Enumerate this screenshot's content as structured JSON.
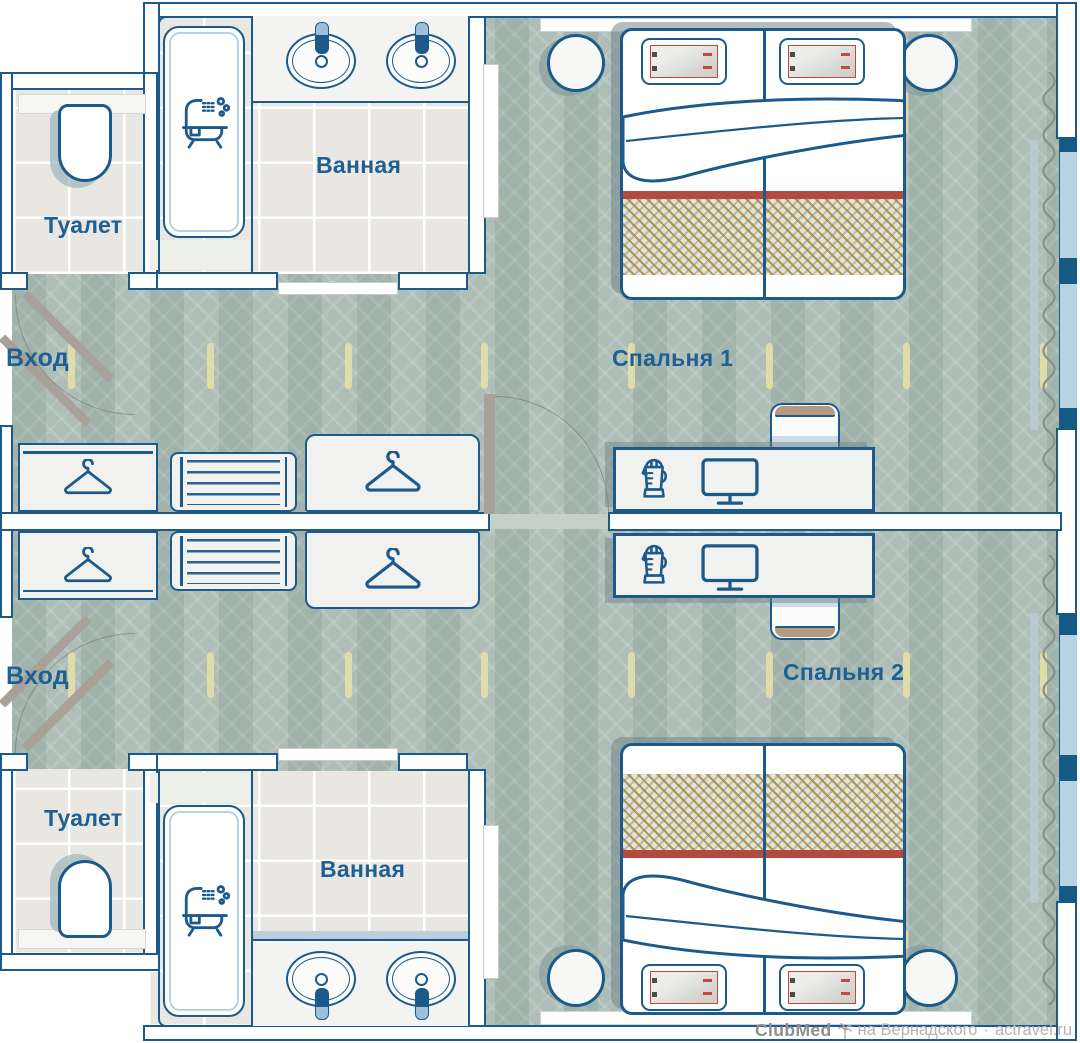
{
  "page": {
    "type": "hotel-room-floor-plan",
    "rooms_shown": 2
  },
  "labels": {
    "entrance": "Вход",
    "toilet": "Туалет",
    "bathroom": "Ванная",
    "bedroom1": "Спальня 1",
    "bedroom2": "Спальня 2"
  },
  "watermark": {
    "brand": "ClubMed",
    "location": "на Вернадского",
    "separator": "·",
    "site": "actravel.ru"
  },
  "icons": {
    "toilet-icon": "toilet top view",
    "bathtub-icon": "bathtub with shower and bubbles",
    "sink-icon": "washbasin with faucet",
    "hanger-icon": "clothes hanger (wardrobe)",
    "shelf-icon": "shelf unit",
    "kettle-icon": "electric kettle",
    "monitor-icon": "tv / monitor on desk",
    "palm-icon": "palm tree (ClubMed logo)",
    "curtain-icon": "window curtain wave"
  },
  "colors": {
    "wall_outline": "#1d5a8c",
    "label_text": "#1e6093",
    "carpet": "#a9bab2",
    "tile_floor": "#e9e7e1",
    "furniture_fill": "#f1f2ef",
    "bed_stripe_red": "#b4493f",
    "blanket_tan": "#a8883a",
    "window_glass": "#b7d2e3",
    "door_gray": "#a8a19a",
    "carpet_accent_yellow": "#e8e0a4",
    "watermark_gray": "#b5b3ae"
  }
}
